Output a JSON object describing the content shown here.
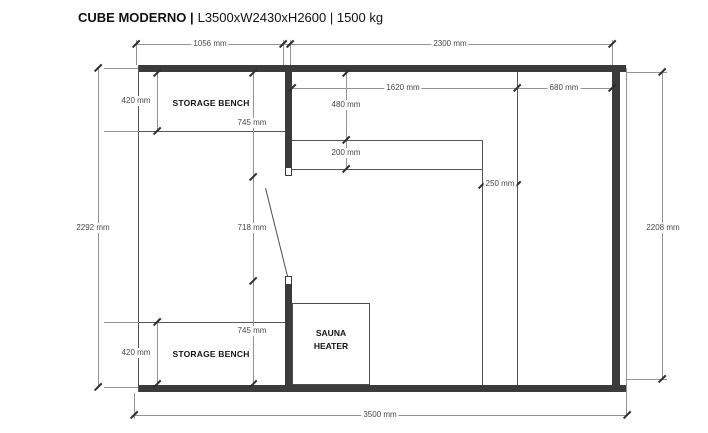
{
  "title": {
    "brand": "CUBE MODERNO |",
    "specs": "L3500xW2430xH2600 | 1500 kg"
  },
  "labels": {
    "storage_bench_top": "STORAGE BENCH",
    "storage_bench_bottom": "STORAGE BENCH",
    "sauna_heater_line1": "SAUNA",
    "sauna_heater_line2": "HEATER"
  },
  "dimensions": {
    "top_left_width": "1056 mm",
    "top_right_width": "2300 mm",
    "interior_height_left": "2292 mm",
    "interior_height_right": "2208 mm",
    "overall_width": "3500 mm",
    "bench_top_depth": "420 mm",
    "partition_top_length": "745 mm",
    "door_opening": "718 mm",
    "partition_bottom_length": "745 mm",
    "bench_bottom_depth": "420 mm",
    "interior_top_left_width": "1620 mm",
    "interior_top_right_width": "680 mm",
    "upper_bench_depth": "480 mm",
    "backrest_depth": "200 mm",
    "divider_gap": "250 mm"
  },
  "colors": {
    "wall": "#3b3b3b",
    "interior_line": "#555555",
    "dimension_line": "#949494",
    "dimension_text": "#474747",
    "label_text": "#141414"
  }
}
